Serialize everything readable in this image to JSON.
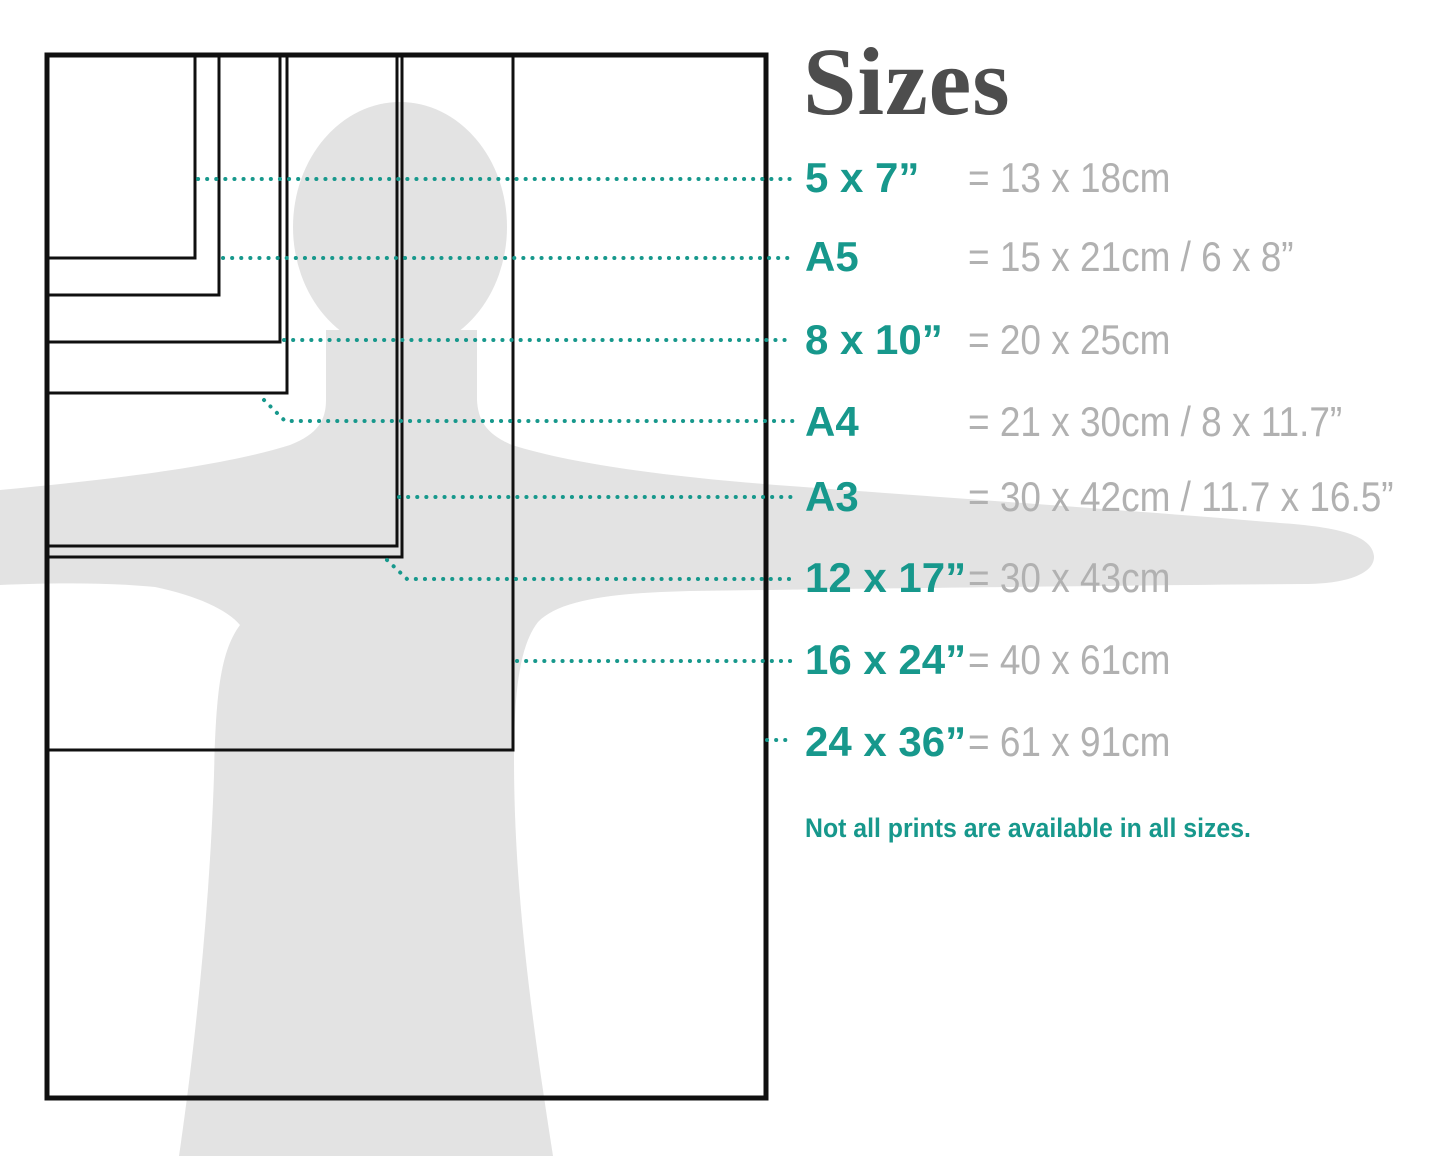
{
  "title": "Sizes",
  "note": "Not all prints are available in all sizes.",
  "rows": [
    {
      "label": "5 x 7”",
      "metric": "= 13 x 18cm"
    },
    {
      "label": "A5",
      "metric": "= 15 x 21cm / 6 x 8”"
    },
    {
      "label": "8 x 10”",
      "metric": "= 20 x 25cm"
    },
    {
      "label": "A4",
      "metric": "= 21 x 30cm / 8 x 11.7”"
    },
    {
      "label": "A3",
      "metric": "= 30 x 42cm / 11.7 x 16.5”"
    },
    {
      "label": "12 x 17”",
      "metric": "= 30 x 43cm"
    },
    {
      "label": "16 x 24”",
      "metric": "= 40 x 61cm"
    },
    {
      "label": "24 x 36”",
      "metric": "= 61 x 91cm"
    }
  ],
  "colors": {
    "accent_teal": "#17988c",
    "metric_gray": "#b1b1b1",
    "title_gray": "#4d4d4d",
    "silhouette_gray": "#e3e3e3",
    "outline_black": "#101010"
  }
}
